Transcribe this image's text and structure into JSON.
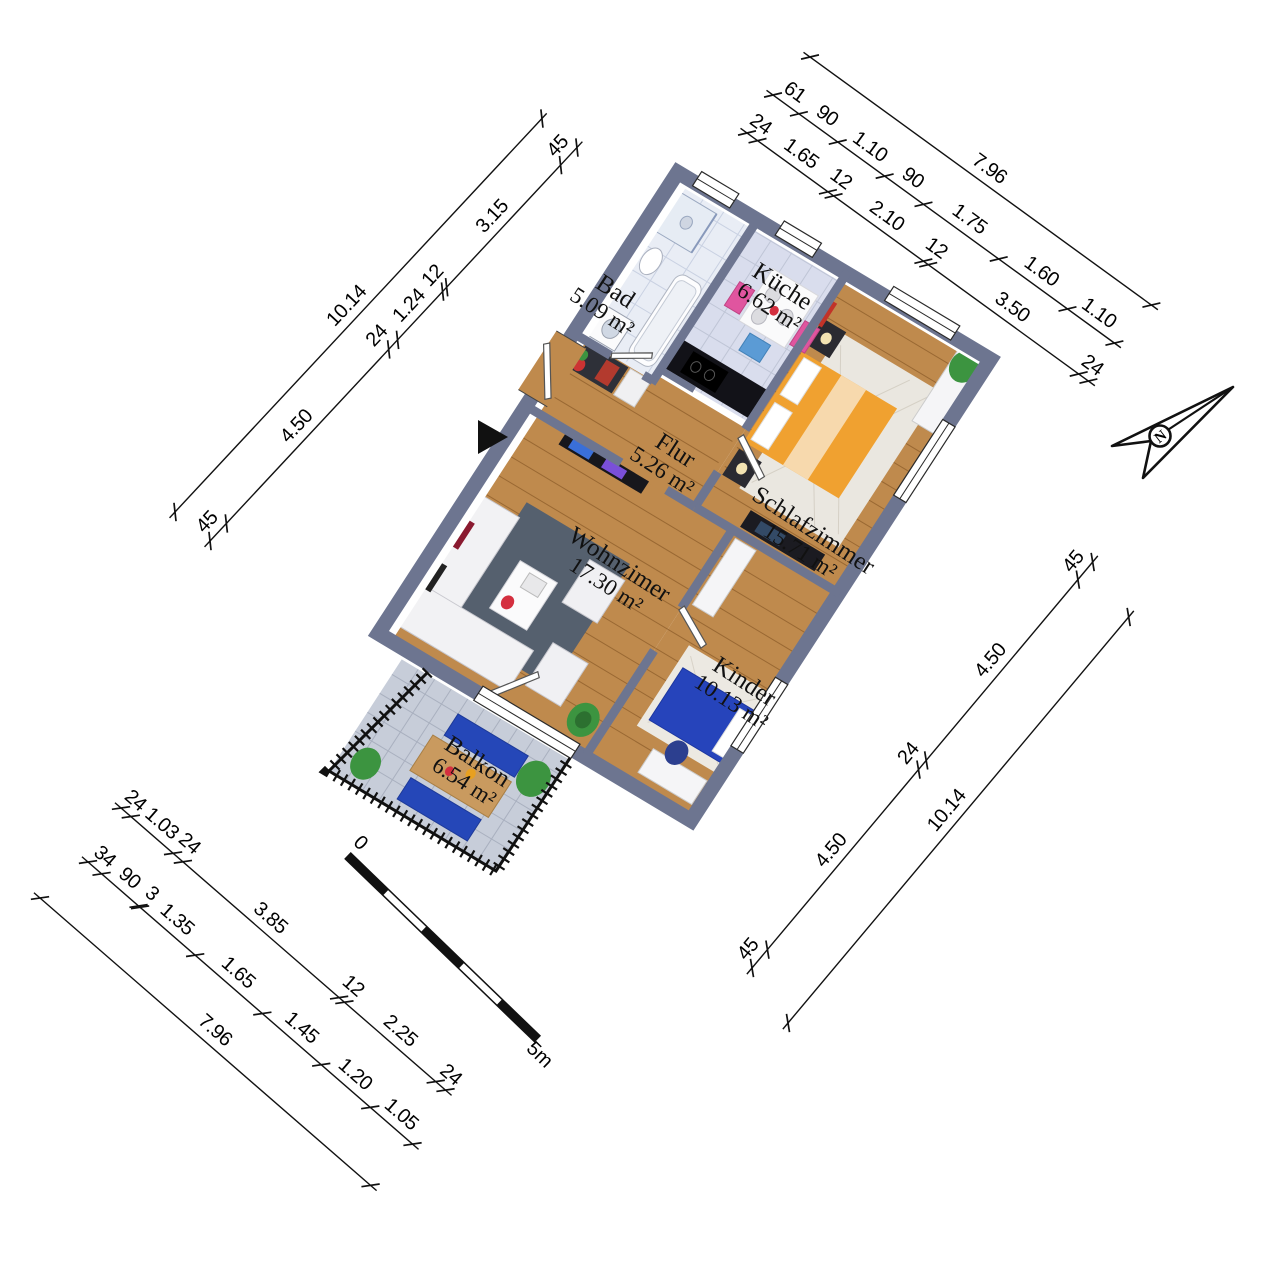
{
  "floorplan": {
    "rooms": [
      {
        "name": "Bad",
        "area": "5.09 m²"
      },
      {
        "name": "Küche",
        "area": "6.62 m²"
      },
      {
        "name": "Flur",
        "area": "5.26 m²"
      },
      {
        "name": "Schlafzimmer",
        "area": "15.71 m²"
      },
      {
        "name": "Wohnzimer",
        "area": "17.30 m²"
      },
      {
        "name": "Kinder",
        "area": "10.13 m²"
      },
      {
        "name": "Balkon",
        "area": "6.54 m²"
      }
    ],
    "dims": {
      "nw": {
        "outer": [
          "10.14"
        ],
        "inner": [
          "45",
          "4.50",
          "24",
          "1.24",
          "12",
          "3.15",
          "45"
        ]
      },
      "ne": {
        "outer": [
          "7.96"
        ],
        "middle": [
          "61",
          "90",
          "1.10",
          "90",
          "1.75",
          "1.60",
          "1.10"
        ],
        "inner": [
          "24",
          "1.65",
          "12",
          "2.10",
          "12",
          "3.50",
          "24"
        ]
      },
      "se": {
        "outer": [
          "10.14"
        ],
        "inner": [
          "45",
          "4.50",
          "24",
          "4.50",
          "45"
        ]
      },
      "sw": {
        "outer": [
          "7.96"
        ],
        "middle": [
          "34",
          "90",
          "3",
          "1.35",
          "1.65",
          "1.45",
          "1.20",
          "1.05"
        ],
        "inner": [
          "24",
          "1.03",
          "24",
          "3.85",
          "12",
          "2.25",
          "24"
        ]
      }
    },
    "scale_bar": {
      "start": "0",
      "end": "5m"
    },
    "north": {
      "label": "N"
    },
    "colors": {
      "wall": "#6d7590",
      "wood_floor": "#bf8a4d",
      "bath_tile": "#e9edf5",
      "kitchen_tile": "#d9dded",
      "balcony_tile": "#c7cdd9",
      "bed_orange": "#f0a130",
      "kid_bed_blue": "#2644bb",
      "rug_dark": "#55606e",
      "sofa_white": "#f2f2f4",
      "plant_green": "#3c9440",
      "chair_pink": "#e0559f"
    }
  }
}
